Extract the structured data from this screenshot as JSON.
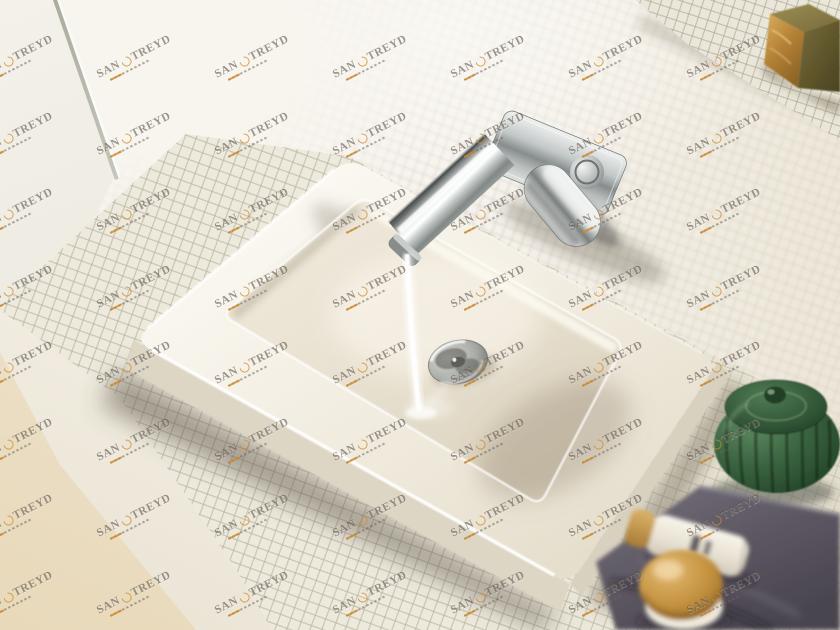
{
  "watermark": {
    "part1": "SAN",
    "part2": "TREYD",
    "text_color": "#5a5148",
    "accent_color": "#cf8a33",
    "grid": {
      "cols": 7,
      "rows": 8,
      "x0": 22,
      "y0": 57,
      "dx": 118,
      "dy": 76.5,
      "angle_deg": -27
    }
  },
  "scene": {
    "description": "Wall-mounted chrome single-lever mixer with flat spout running water into a white rectangular washbasin on a white mosaic-tiled counter",
    "objects": [
      {
        "name": "mosaic-wall",
        "color": "#f6f3ee"
      },
      {
        "name": "mosaic-counter",
        "color": "#edeadd"
      },
      {
        "name": "washbasin",
        "color": "#f2eee6"
      },
      {
        "name": "faucet-chrome",
        "color": "#b9bebd"
      },
      {
        "name": "water-stream",
        "color": "#ffffff"
      },
      {
        "name": "drain-chrome",
        "color": "#a9aba6"
      },
      {
        "name": "soap-block",
        "colors": [
          "#c89a52",
          "#6b603a"
        ]
      },
      {
        "name": "green-ceramic-jar",
        "color": "#2f5233"
      },
      {
        "name": "purple-towel",
        "color": "#5c5662"
      },
      {
        "name": "cosmetic-tube",
        "colors": [
          "#f1ebdf",
          "#b98a3e"
        ]
      },
      {
        "name": "cream-jar-gold-lid",
        "color": "#c3913f"
      },
      {
        "name": "floor",
        "color": "#ecdfc6"
      }
    ]
  }
}
